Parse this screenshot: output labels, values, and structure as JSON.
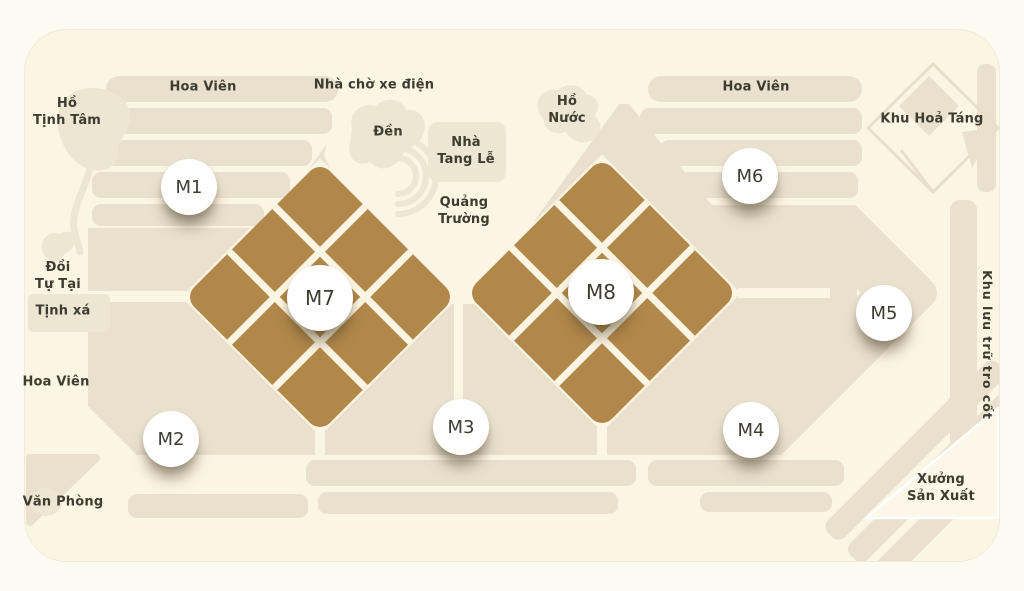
{
  "map": {
    "badges": [
      {
        "id": "M1",
        "label": "M1"
      },
      {
        "id": "M2",
        "label": "M2"
      },
      {
        "id": "M3",
        "label": "M3"
      },
      {
        "id": "M4",
        "label": "M4"
      },
      {
        "id": "M5",
        "label": "M5"
      },
      {
        "id": "M6",
        "label": "M6"
      },
      {
        "id": "M7",
        "label": "M7"
      },
      {
        "id": "M8",
        "label": "M8"
      }
    ],
    "labels": {
      "hoa_vien_nw": "Hoa Viên",
      "ho_tinh_tam": [
        "Hồ",
        "Tịnh Tâm"
      ],
      "nha_cho_xe_dien": "Nhà chờ xe điện",
      "den": "Đền",
      "nha_tang_le": [
        "Nhà",
        "Tang Lễ"
      ],
      "ho_nuoc": [
        "Hồ",
        "Nước"
      ],
      "hoa_vien_ne": "Hoa Viên",
      "khu_hoa_tang": "Khu Hoả Táng",
      "quang_truong": [
        "Quảng",
        "Trường"
      ],
      "doi_tu_tai": [
        "Đồi",
        "Tự Tại"
      ],
      "tinh_xa": "Tịnh xá",
      "hoa_vien_w": "Hoa Viên",
      "van_phong": "Văn Phòng",
      "xuong_san_xuat": [
        "Xưởng",
        "Sản Xuất"
      ],
      "khu_luu_tru_tro_cot": "Khu lưu trữ tro cốt"
    },
    "colors": {
      "page_background": "#FDFAF2",
      "map_background": "#FBF5E3",
      "plot_fill": "#E9E1CE",
      "feature_fill": "#EDE6D3",
      "block_accent_brown": "#B2884A",
      "badge_background": "#FFFFFF",
      "text": "#3E3C31"
    }
  }
}
